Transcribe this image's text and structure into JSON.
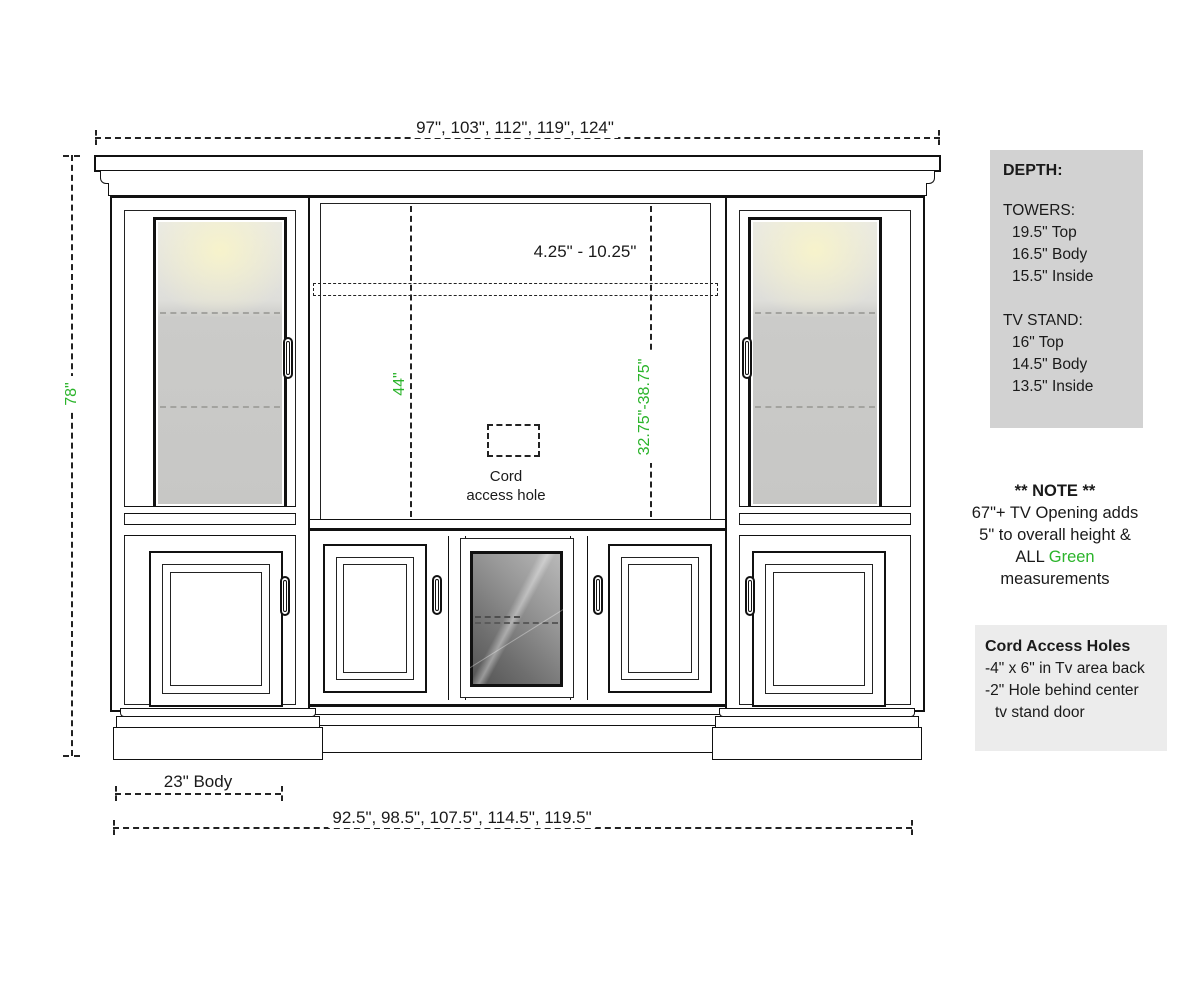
{
  "diagram": {
    "top_width_label": "97\", 103\", 112\", 119\", 124\"",
    "bottom_width_label": "92.5\", 98.5\", 107.5\", 114.5\", 119.5\"",
    "height_label": "78\"",
    "body_depth_label": "23\" Body",
    "crown_range_label": "4.25\" - 10.25\"",
    "tv_opening_height_label": "44\"",
    "tv_height_range_label": "32.75\"-38.75\"",
    "cord_hole_line1": "Cord",
    "cord_hole_line2": "access hole"
  },
  "side_panel": {
    "depth_box": {
      "title": "DEPTH:",
      "sections": [
        {
          "heading": "TOWERS:",
          "items": [
            "19.5\" Top",
            "16.5\" Body",
            "15.5\" Inside"
          ]
        },
        {
          "heading": "TV STAND:",
          "items": [
            "16\" Top",
            "14.5\" Body",
            "13.5\" Inside"
          ]
        }
      ]
    },
    "note": {
      "title": "** NOTE **",
      "line1": "67\"+ TV Opening adds",
      "line2": "5\" to overall height &",
      "line3_prefix": "ALL ",
      "line3_green": "Green",
      "line4": "measurements"
    },
    "cord_box": {
      "title": "Cord Access Holes",
      "line1": "-4\" x 6\" in Tv area back",
      "line2": "-2\" Hole behind center",
      "line3": "tv stand door"
    }
  },
  "colors": {
    "green": "#2bb42b",
    "depth_box_bg": "#d2d2d2",
    "cord_box_bg": "#ececec"
  }
}
